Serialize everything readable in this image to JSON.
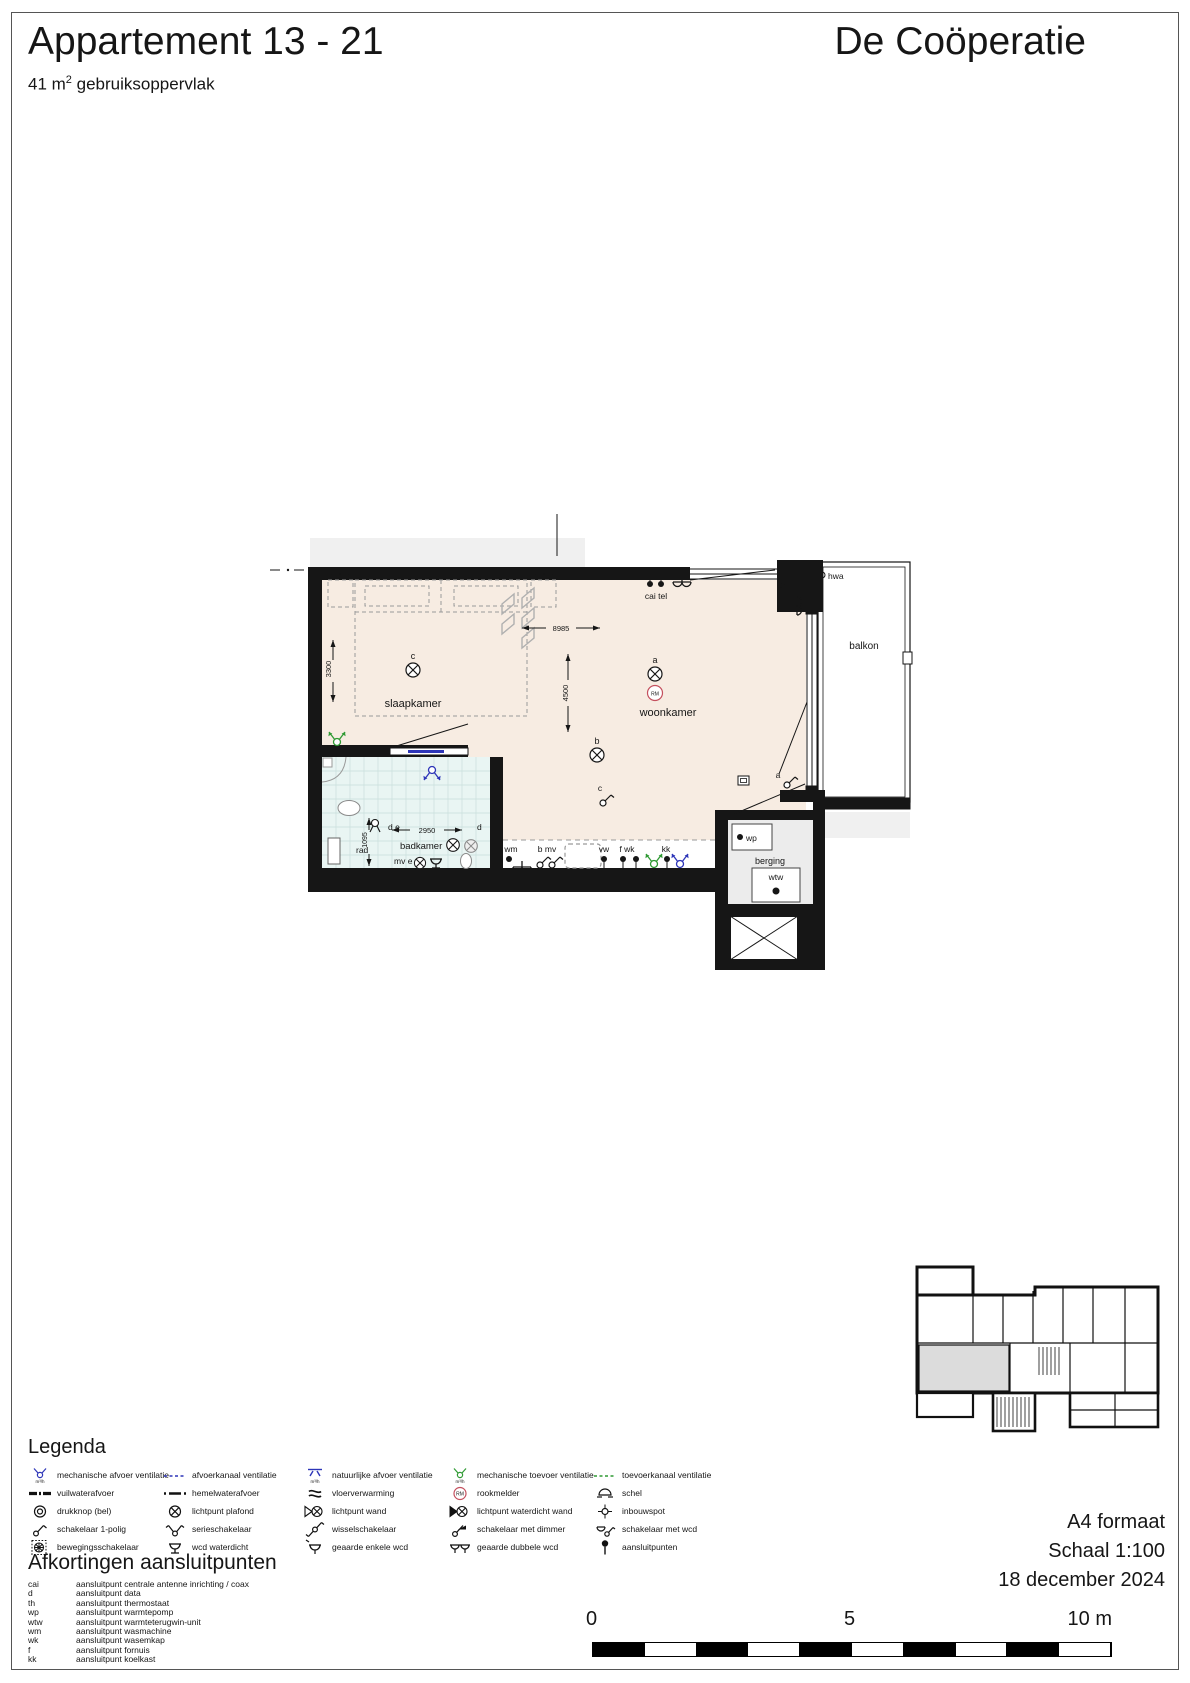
{
  "header": {
    "title": "Appartement 13 - 21",
    "area_value": "41 m",
    "area_sup": "2",
    "area_suffix": " gebruiksoppervlak",
    "brand": "De Coöperatie"
  },
  "plan": {
    "rooms": {
      "slaapkamer": "slaapkamer",
      "woonkamer": "woonkamer",
      "badkamer": "badkamer",
      "balkon": "balkon",
      "berging": "berging"
    },
    "annotations": {
      "cai_tel": "cai tel",
      "th": "th",
      "hwa": "hwa",
      "wp": "wp",
      "wtw": "wtw",
      "rad": "rad",
      "wm": "wm",
      "b_mv": "b mv",
      "vw": "vw",
      "f_wk": "f wk",
      "kk": "kk",
      "d_e": "d e",
      "d": "d",
      "mv_e": "mv e",
      "a": "a",
      "b": "b",
      "c": "c",
      "rm": "RM"
    },
    "dimensions": {
      "living_width": "8985",
      "living_depth": "4500",
      "bedroom_depth": "3300",
      "bathroom_width": "2950",
      "bathroom_depth": "1095"
    }
  },
  "legend": {
    "title": "Legenda",
    "vent_unit": "m³/h",
    "rm": "RM",
    "items": [
      {
        "label": "mechanische afvoer ventilatie"
      },
      {
        "label": "afvoerkanaal ventilatie"
      },
      {
        "label": "natuurlijke afvoer ventilatie"
      },
      {
        "label": "mechanische toevoer ventilatie"
      },
      {
        "label": "toevoerkanaal ventilatie"
      },
      {
        "label": "vuilwaterafvoer"
      },
      {
        "label": "hemelwaterafvoer"
      },
      {
        "label": "vloerverwarming"
      },
      {
        "label": "rookmelder"
      },
      {
        "label": "schel"
      },
      {
        "label": "drukknop (bel)"
      },
      {
        "label": "lichtpunt plafond"
      },
      {
        "label": "lichtpunt wand"
      },
      {
        "label": "lichtpunt waterdicht wand"
      },
      {
        "label": "inbouwspot"
      },
      {
        "label": "schakelaar 1-polig"
      },
      {
        "label": "serieschakelaar"
      },
      {
        "label": "wisselschakelaar"
      },
      {
        "label": "schakelaar met dimmer"
      },
      {
        "label": "schakelaar met wcd"
      },
      {
        "label": "bewegingsschakelaar"
      },
      {
        "label": "wcd waterdicht"
      },
      {
        "label": "geaarde enkele wcd"
      },
      {
        "label": "geaarde dubbele wcd"
      },
      {
        "label": "aansluitpunten"
      }
    ]
  },
  "abbreviations": {
    "title": "Afkortingen aansluitpunten",
    "items": [
      {
        "abbr": "cai",
        "label": "aansluitpunt centrale antenne inrichting / coax"
      },
      {
        "abbr": "d",
        "label": "aansluitpunt data"
      },
      {
        "abbr": "th",
        "label": "aansluitpunt thermostaat"
      },
      {
        "abbr": "wp",
        "label": "aansluitpunt warmtepomp"
      },
      {
        "abbr": "wtw",
        "label": "aansluitpunt warmteterugwin-unit"
      },
      {
        "abbr": "wm",
        "label": "aansluitpunt wasmachine"
      },
      {
        "abbr": "wk",
        "label": "aansluitpunt wasemkap"
      },
      {
        "abbr": "f",
        "label": "aansluitpunt fornuis"
      },
      {
        "abbr": "kk",
        "label": "aansluitpunt koelkast"
      }
    ]
  },
  "footer": {
    "paper": "A4 formaat",
    "scale": "Schaal 1:100",
    "date": "18 december 2024",
    "scalebar": {
      "zero": "0",
      "five": "5",
      "ten": "10 m"
    }
  }
}
